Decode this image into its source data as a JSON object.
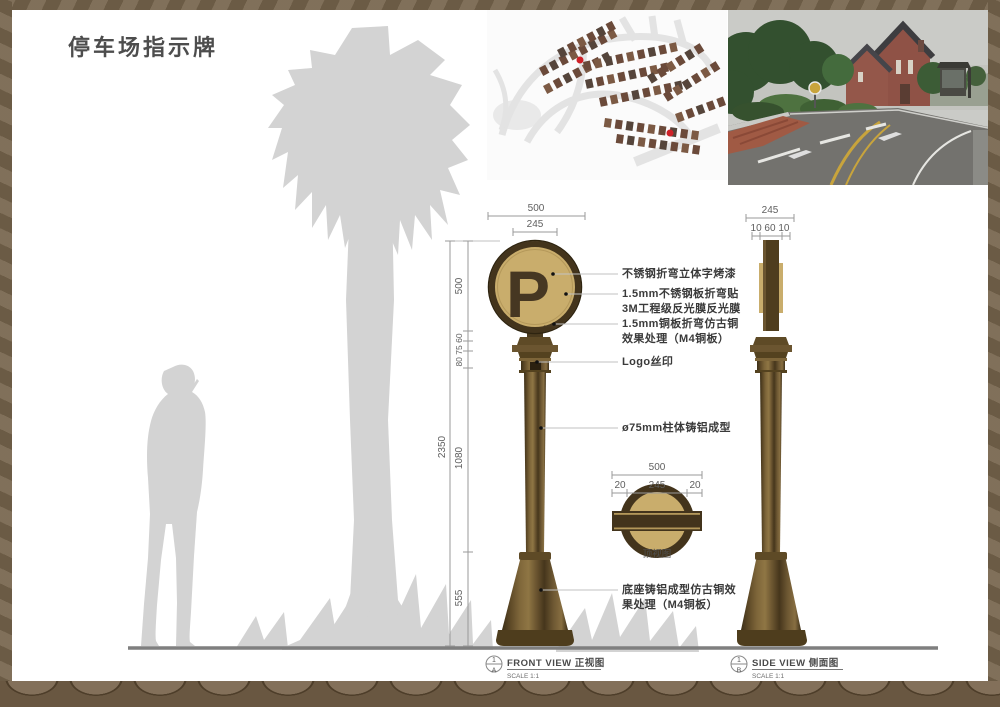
{
  "title": "停车场指示牌",
  "sign": {
    "letter": "P",
    "arrow": "→"
  },
  "callouts": [
    {
      "lines": [
        "不锈钢折弯立体字烤漆"
      ]
    },
    {
      "lines": [
        "1.5mm不锈钢板折弯贴",
        "3M工程级反光膜反光膜"
      ]
    },
    {
      "lines": [
        "1.5mm铜板折弯仿古铜",
        "效果处理（M4铜板）"
      ]
    },
    {
      "lines": [
        "Logo丝印"
      ]
    },
    {
      "lines": [
        "ø75mm柱体铸铝成型"
      ]
    },
    {
      "lines": [
        "底座铸铝成型仿古铜效",
        "果处理（M4铜板）"
      ]
    }
  ],
  "dimensions": {
    "front": {
      "overall_width": "500",
      "sign_width": "245",
      "total_height": "2350",
      "chain_sign": "500",
      "chain_upper": "80 75 60",
      "chain_pole": "1080",
      "chain_base": "555"
    },
    "side": {
      "width": "245",
      "chain": "10 60 10"
    },
    "top": {
      "overall": "500",
      "left": "20",
      "center": "245",
      "right": "20",
      "label": "顶视图"
    }
  },
  "views": {
    "front": {
      "ref_num": "1",
      "ref_sheet": "A",
      "label": "FRONT VIEW 正视图",
      "scale": "SCALE 1:1"
    },
    "side": {
      "ref_num": "1",
      "ref_sheet": "B",
      "label": "SIDE VIEW 侧面图",
      "scale": "SCALE 1:1"
    }
  },
  "colors": {
    "bronze_dark": "#43341c",
    "bronze_mid": "#6b5530",
    "sign_tan": "#c9ad6c",
    "silhouette": "#d3d3d3",
    "marker_red": "#cf2128"
  }
}
